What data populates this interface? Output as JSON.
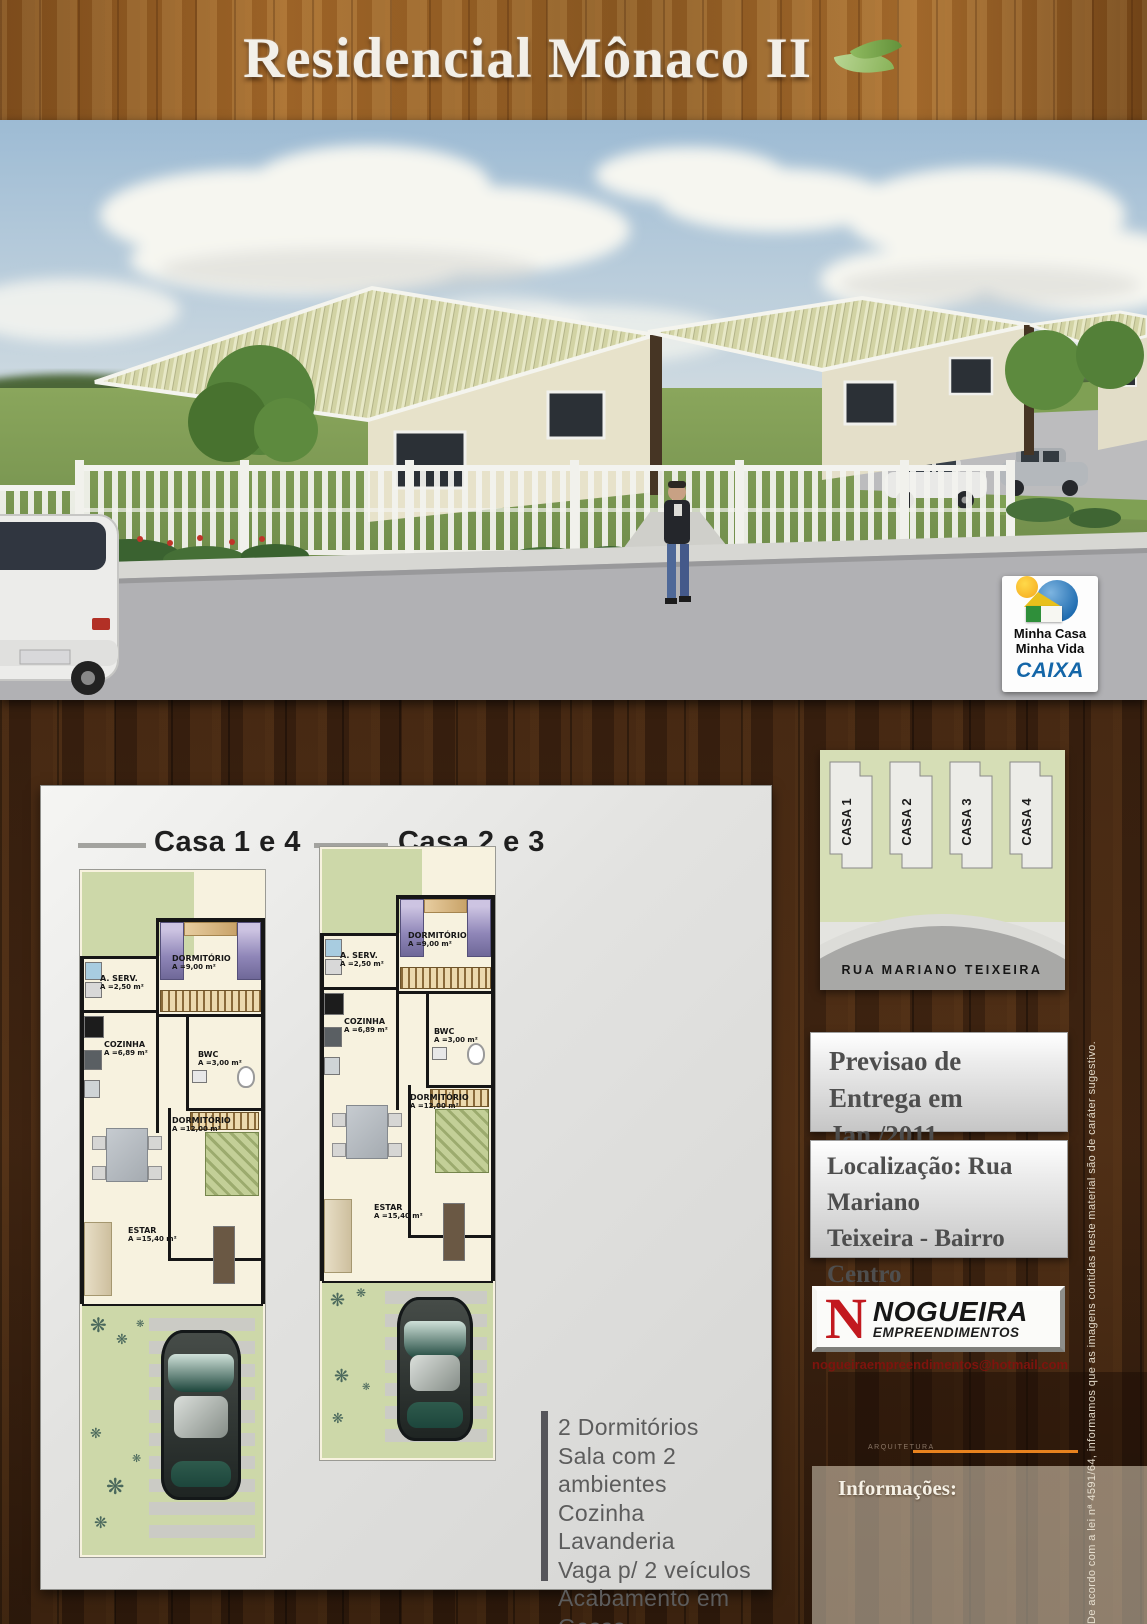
{
  "poster": {
    "title": "Residencial Mônaco II"
  },
  "hero": {
    "mcmv": {
      "line1": "Minha Casa",
      "line2": "Minha Vida",
      "bank": "CAIXA"
    }
  },
  "floorplans": {
    "header_a": "Casa 1 e 4",
    "header_b": "Casa 2 e 3",
    "rooms": [
      {
        "name": "A. SERV.",
        "area": "A =2,50 m²"
      },
      {
        "name": "DORMITÓRIO",
        "area": "A =9,00 m²"
      },
      {
        "name": "COZINHA",
        "area": "A =6,89 m²"
      },
      {
        "name": "BWC",
        "area": "A =3,00 m²"
      },
      {
        "name": "DORMITÓRIO",
        "area": "A =12,00 m²"
      },
      {
        "name": "ESTAR",
        "area": "A =15,40 m²"
      }
    ]
  },
  "features": [
    "2 Dormitórios",
    "Sala com 2 ambientes",
    "Cozinha",
    "Lavanderia",
    "Vaga p/ 2 veículos",
    "Acabamento em Gesso"
  ],
  "siteplan": {
    "houses": [
      "CASA 1",
      "CASA 2",
      "CASA 3",
      "CASA 4"
    ],
    "street": "RUA MARIANO TEIXEIRA"
  },
  "delivery": {
    "line1": "Previsao de",
    "line2": "Entrega em Jan./2011"
  },
  "location": {
    "line1": "Localização: Rua Mariano",
    "line2": "Teixeira - Bairro Centro",
    "line3": "Camboriu/SC"
  },
  "developer": {
    "initial": "N",
    "name": "NOGUEIRA",
    "subtitle": "EMPREENDIMENTOS",
    "email": "nogueiraempreendimentos@hotmail.com",
    "tagline": "ARQUITETURA"
  },
  "info_label": "Informações:",
  "legal": {
    "disclaimer": "De acordo com a lei nª 4591/64, informamos que as imagens contidas neste material são de caráter sugestivo."
  },
  "icons": {
    "plant": "❋"
  },
  "colors": {
    "caixa_blue": "#1466a8",
    "mcmv_orange": "#f5a81c",
    "nogueira_red": "#c2191f",
    "leaf_green": "#8fba60",
    "accent_orange": "#e8821e",
    "roof_green": "#d2d3a4",
    "wood_dark": "#3a2010"
  }
}
